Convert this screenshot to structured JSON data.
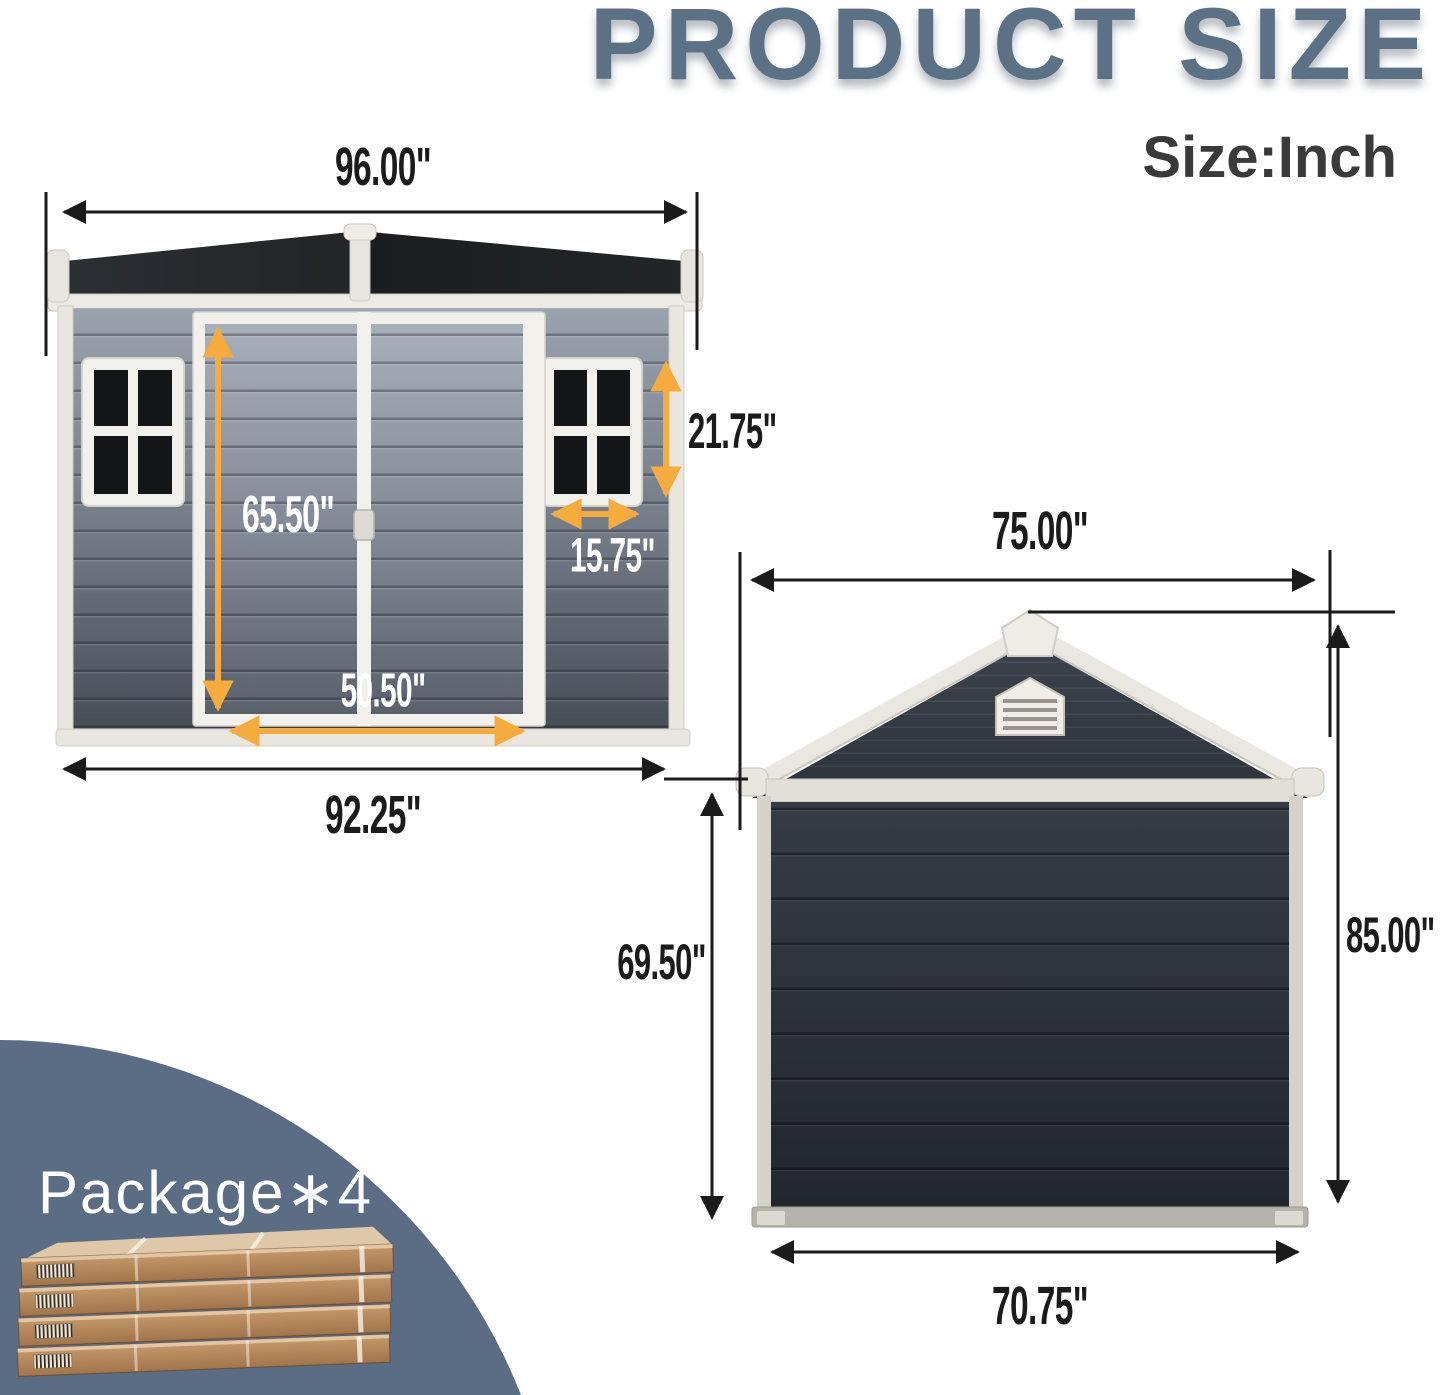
{
  "header": {
    "title": "PRODUCT SIZE",
    "unit_label": "Size:Inch"
  },
  "front_view": {
    "dimensions": {
      "roof_width": "96.00\"",
      "door_height": "65.50\"",
      "window_height": "21.75\"",
      "window_width": "15.75\"",
      "door_width": "50.50\"",
      "body_width": "92.25\""
    }
  },
  "back_view": {
    "dimensions": {
      "roof_width": "75.00\"",
      "wall_height": "69.50\"",
      "total_height": "85.00\"",
      "base_width": "70.75\""
    }
  },
  "package": {
    "label": "Package∗4",
    "count": "4"
  },
  "colors": {
    "title_blue": "#5B7186",
    "dimension_black": "#1B1B1B",
    "accent_orange": "#F5AC3D",
    "badge_blue": "#5A6D84",
    "roof_dark": "#1F2225",
    "wall_gray": "#8A93A0",
    "trim_white": "#EDEAE4",
    "cardboard_brown": "#B5854F"
  }
}
